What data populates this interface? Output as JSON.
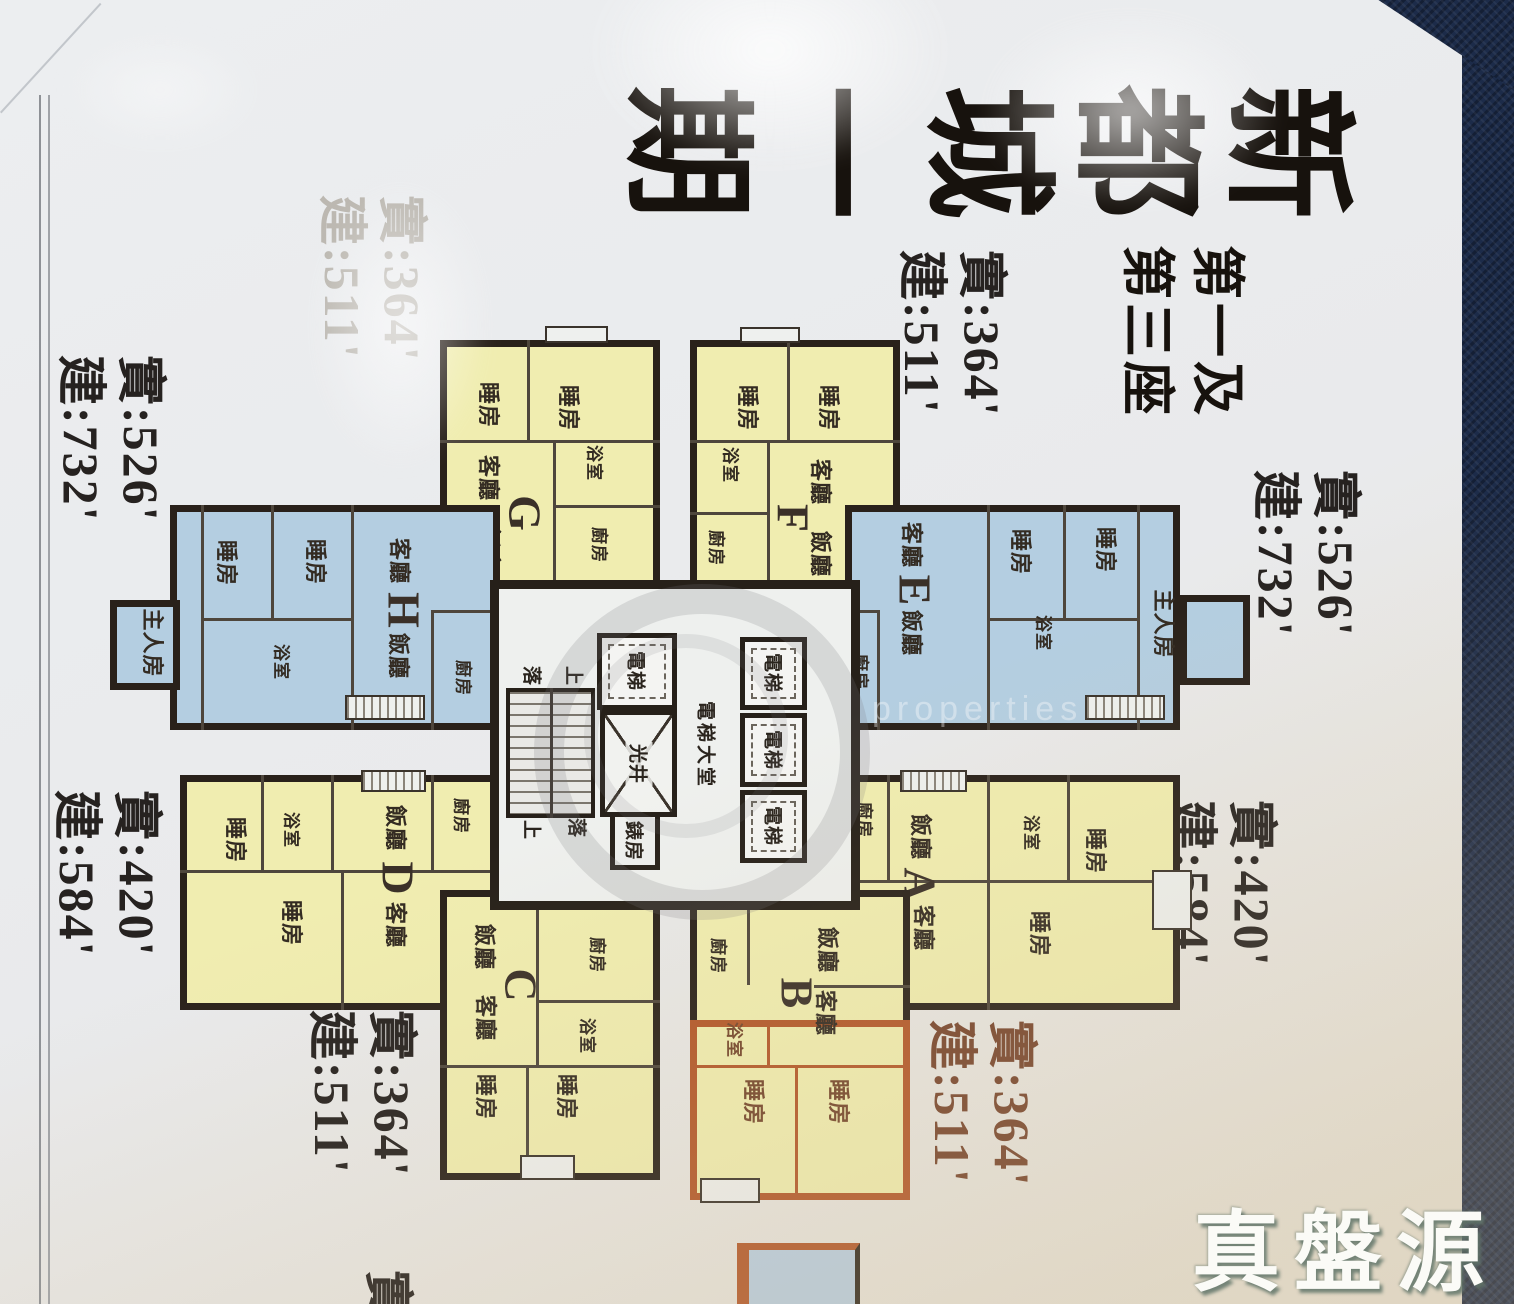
{
  "photo": {
    "brand_watermark": "真盤源",
    "brand_sub": "properties"
  },
  "colors": {
    "unit_yellow": "#f0edb0",
    "unit_blue": "#b4cee1",
    "highlight_orange": "#b3582a",
    "wall_dark": "#29211a",
    "fabric_navy": "#1c2b49",
    "paper": "#e9eaec"
  },
  "flyer": {
    "title": "新都城一期",
    "subtitle_line1": "第一及",
    "subtitle_line2": "第三座",
    "partial_label": "實",
    "labels": {
      "bedroom": "睡房",
      "master_bedroom": "主人房",
      "living": "客廳",
      "dining": "飯廳",
      "bath": "浴室",
      "kitchen": "廚房",
      "lift": "電梯",
      "lift_lobby": "電梯大堂",
      "light_well": "光井",
      "meter_room": "錶房",
      "stair_up": "上",
      "stair_down": "落"
    },
    "units": {
      "A": {
        "letter": "A",
        "area_net": "實:420'",
        "area_gross": "建:584'"
      },
      "B": {
        "letter": "B",
        "area_net": "實:364'",
        "area_gross": "建:511'"
      },
      "C": {
        "letter": "C",
        "area_net": "實:364'",
        "area_gross": "建:511'"
      },
      "D": {
        "letter": "D",
        "area_net": "實:420'",
        "area_gross": "建:584'"
      },
      "E": {
        "letter": "E",
        "area_net": "實:526'",
        "area_gross": "建:732'"
      },
      "F": {
        "letter": "F",
        "area_net": "實:364'",
        "area_gross": "建:511'"
      },
      "G": {
        "letter": "G",
        "area_net": "實:364'",
        "area_gross": "建:511'"
      },
      "H": {
        "letter": "H",
        "area_net": "實:526'",
        "area_gross": "建:732'"
      }
    }
  }
}
